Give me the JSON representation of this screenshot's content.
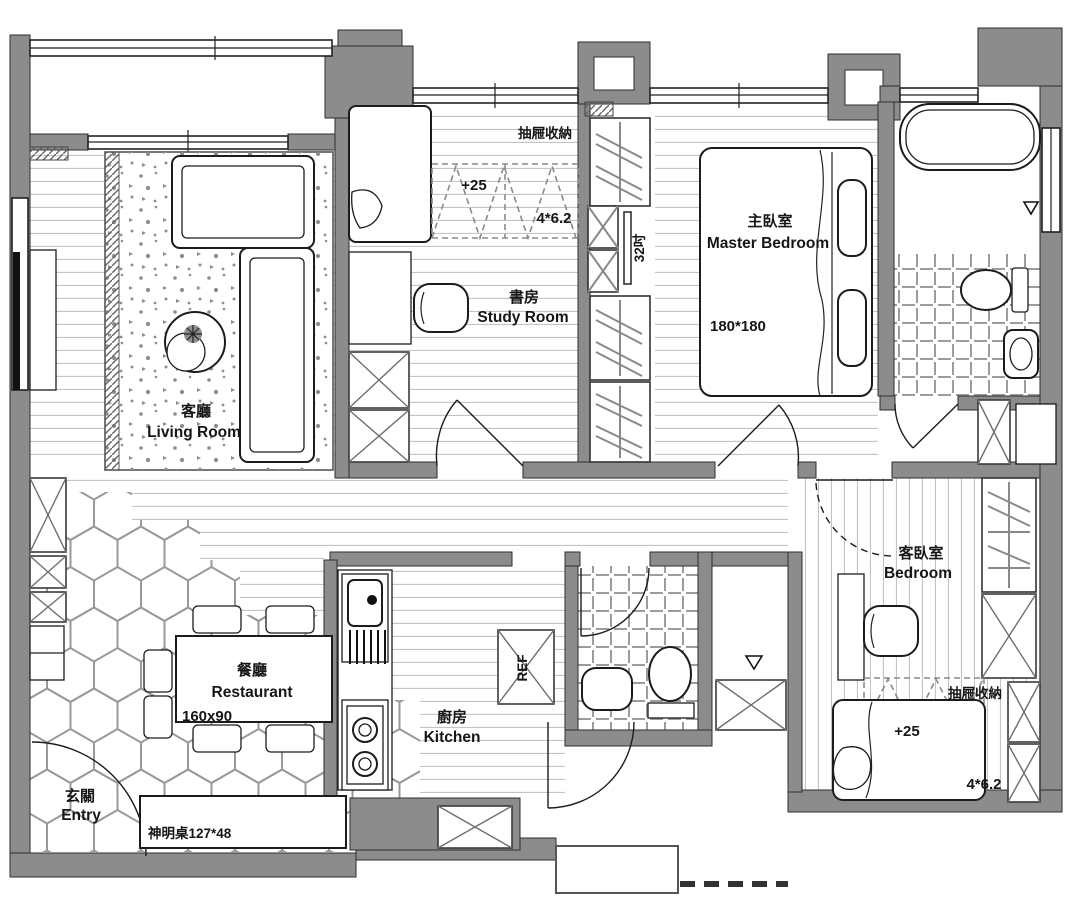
{
  "plan": {
    "rooms": {
      "living": {
        "zh": "客廳",
        "en": "Living Room"
      },
      "study": {
        "zh": "書房",
        "en": "Study Room"
      },
      "master": {
        "zh": "主臥室",
        "en": "Master Bedroom",
        "bed_size": "180*180"
      },
      "guest": {
        "zh": "客臥室",
        "en": "Bedroom"
      },
      "dining": {
        "zh": "餐廳",
        "en": "Restaurant",
        "table_size": "160x90"
      },
      "kitchen": {
        "zh": "廚房",
        "en": "Kitchen"
      },
      "entry": {
        "zh": "玄關",
        "en": "Entry"
      }
    },
    "annotations": {
      "study_storage": {
        "label": "抽屜收納",
        "level": "+25",
        "size": "4*6.2"
      },
      "guest_storage": {
        "label": "抽屜收納",
        "level": "+25",
        "size": "4*6.2"
      },
      "tv_size": "32吋",
      "fridge": "REF",
      "altar": "神明桌127*48"
    },
    "colors": {
      "wall": "#8c8c8c",
      "line": "#1c1c1c",
      "floor_line": "#c4c4c4",
      "tile_line": "#9c9c9c"
    }
  }
}
